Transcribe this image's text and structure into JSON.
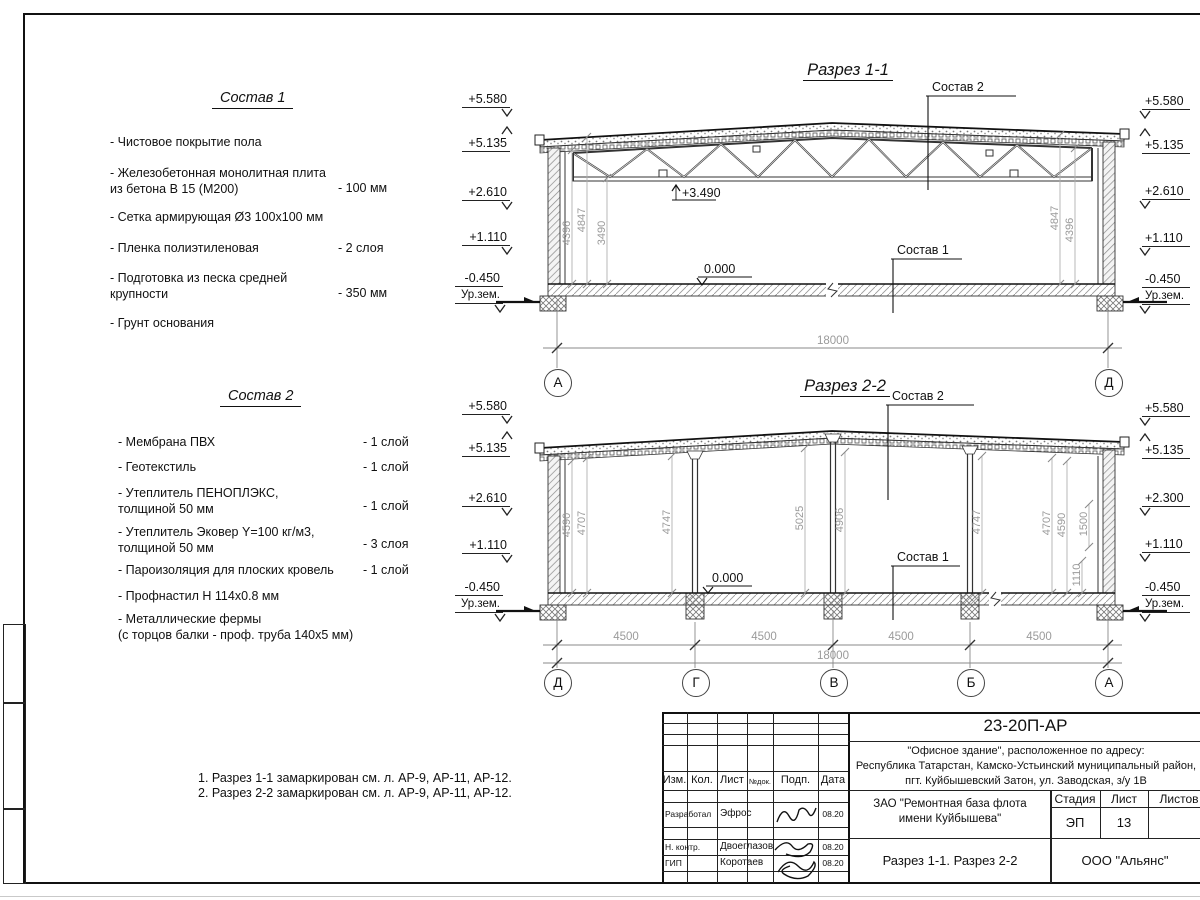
{
  "sostav1": {
    "title": "Состав 1",
    "items": [
      {
        "text": "- Чистовое покрытие пола",
        "value": ""
      },
      {
        "text": "- Железобетонная  монолитная плита\nиз бетона В 15 (М200)",
        "value": "- 100 мм"
      },
      {
        "text": "- Сетка армирующая Ø3 100х100 мм",
        "value": ""
      },
      {
        "text": "- Пленка полиэтиленовая",
        "value": "-  2 слоя"
      },
      {
        "text": "- Подготовка из песка средней\nкрупности",
        "value": "- 350 мм"
      },
      {
        "text": "- Грунт основания",
        "value": ""
      }
    ]
  },
  "sostav2": {
    "title": "Состав 2",
    "items": [
      {
        "text": "- Мембрана ПВХ",
        "value": "- 1 слой"
      },
      {
        "text": "- Геотекстиль",
        "value": "- 1 слой"
      },
      {
        "text": "- Утеплитель ПЕНОПЛЭКС,\nтолщиной 50 мм",
        "value": "- 1 слой"
      },
      {
        "text": "- Утеплитель Эковер Y=100 кг/м3,\nтолщиной 50 мм",
        "value": "- 3 слоя"
      },
      {
        "text": "- Пароизоляция для плоских кровель",
        "value": "- 1 слой"
      },
      {
        "text": "- Профнастил Н 114х0.8 мм",
        "value": ""
      },
      {
        "text": "- Металлические фермы\n(с торцов балки - проф. труба 140х5 мм)",
        "value": ""
      }
    ]
  },
  "notes": [
    "1. Разрез 1-1 замаркирован см. л. АР-9, АР-11, АР-12.",
    "2. Разрез 2-2 замаркирован см. л. АР-9, АР-11, АР-12."
  ],
  "razrez1": {
    "title": "Разрез 1-1",
    "label_sostav2": "Состав 2",
    "label_sostav1": "Состав 1",
    "elev_left": [
      "+5.580",
      "+5.135",
      "+2.610",
      "+1.110",
      "-0.450"
    ],
    "elev_right": [
      "+5.580",
      "+5.135",
      "+2.610",
      "+1.110",
      "-0.450"
    ],
    "ground": "Ур.зем.",
    "mark_3490": "+3.490",
    "mark_zero": "0.000",
    "vdims": [
      "4396",
      "4847",
      "3490",
      "4847",
      "4396"
    ],
    "dim_total": "18000",
    "axes": [
      "А",
      "Д"
    ]
  },
  "razrez2": {
    "title": "Разрез 2-2",
    "label_sostav2": "Состав 2",
    "label_sostav1": "Состав 1",
    "elev_left": [
      "+5.580",
      "+5.135",
      "+2.610",
      "+1.110",
      "-0.450"
    ],
    "elev_right": [
      "+5.580",
      "+5.135",
      "+2.300",
      "+1.110",
      "-0.450"
    ],
    "ground": "Ур.зем.",
    "mark_zero": "0.000",
    "vdims": [
      "4590",
      "4707",
      "4747",
      "5025",
      "4906",
      "4747",
      "4707",
      "4590",
      "1500",
      "1110"
    ],
    "dim_spans": [
      "4500",
      "4500",
      "4500",
      "4500"
    ],
    "dim_total": "18000",
    "axes": [
      "Д",
      "Г",
      "В",
      "Б",
      "А"
    ]
  },
  "titleblock": {
    "doc_number": "23-20П-АР",
    "address": "\"Офисное здание\", расположенное по адресу:\nРеспублика Татарстан, Камско-Устьинский муниципальный район,\nпгт. Куйбышевский Затон, ул. Заводская, з/у 1В",
    "customer": "ЗАО \"Ремонтная база флота\nимени Куйбышева\"",
    "sheet_title": "Разрез 1-1. Разрез 2-2",
    "company": "ООО \"Альянс\"",
    "cols": [
      "Изм.",
      "Кол.",
      "Лист",
      "№док.",
      "Подп.",
      "Дата"
    ],
    "rows": [
      {
        "role": "Разработал",
        "name": "Эфрос",
        "date": "08.20"
      },
      {
        "role": "Н. контр.",
        "name": "Двоеглазов",
        "date": "08.20"
      },
      {
        "role": "ГИП",
        "name": "Коротаев",
        "date": "08.20"
      }
    ],
    "stage_label": "Стадия",
    "sheet_label": "Лист",
    "sheets_label": "Листов",
    "stage": "ЭП",
    "sheet_no": "13"
  }
}
